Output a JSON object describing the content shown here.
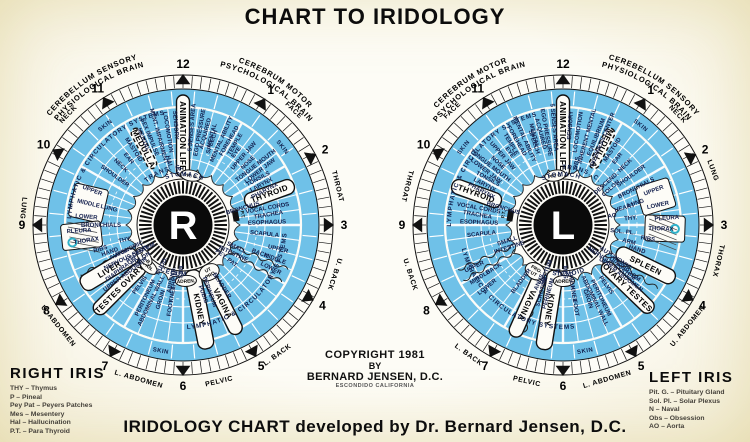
{
  "title": "CHART TO IRIDOLOGY",
  "caption": "IRIDOLOGY CHART developed by Dr. Bernard Jensen, D.C.",
  "copyright": [
    "COPYRIGHT 1981",
    "BY",
    "BERNARD JENSEN, D.C.",
    "ESCONDIDO CALIFORNIA"
  ],
  "colors": {
    "blue": "#6fc1e8",
    "paper": "#fdfcf7",
    "ink": "#0c0c0c",
    "navy": "#14204e",
    "teal": "#2fb1c9"
  },
  "legends": {
    "right": {
      "title": "RIGHT IRIS",
      "items": [
        "THY – Thymus",
        "P – Pineal",
        "Pey Pat – Peyers Patches",
        "Mes – Mesentery",
        "Hal – Hallucination",
        "P.T. – Para Thyroid"
      ]
    },
    "left": {
      "title": "LEFT IRIS",
      "items": [
        "Pit. G. – Pituitary Gland",
        "Sol. Pl. – Solar Plexus",
        "N – Naval",
        "Obs – Obsession",
        "AO – Aorta"
      ]
    }
  },
  "iris_right": {
    "letter": "R",
    "arcs_top": [
      [
        "CEREBELLUM SENSORY",
        -33,
        172
      ],
      [
        "PHYSIOLOGICAL BRAIN",
        -32,
        163
      ],
      [
        "CEREBRUM MOTOR",
        33,
        172
      ],
      [
        "PSYCHOLOGICAL BRAIN",
        32,
        163
      ]
    ],
    "numbers": [
      [
        "12",
        0
      ],
      [
        "1",
        33
      ],
      [
        "2",
        62
      ],
      [
        "3",
        90
      ],
      [
        "4",
        120
      ],
      [
        "5",
        151
      ],
      [
        "6",
        180
      ],
      [
        "7",
        209
      ],
      [
        "8",
        238
      ],
      [
        "9",
        270
      ],
      [
        "10",
        300
      ],
      [
        "11",
        328
      ]
    ],
    "outer": [
      [
        "FACE",
        44
      ],
      [
        "THROAT",
        76
      ],
      [
        "U. BACK",
        108
      ],
      [
        "L. BACK",
        144
      ],
      [
        "PELVIC",
        167
      ],
      [
        "L. ABDOMEN",
        196
      ],
      [
        "U. ABDOMEN",
        231
      ],
      [
        "LUNG",
        276
      ],
      [
        "NECK",
        -46
      ]
    ],
    "ring": [
      [
        "SKIN",
        -38
      ],
      [
        "SKIN",
        52
      ],
      [
        "SKIN",
        190
      ]
    ],
    "radial": [
      [
        "SENSORY",
        -4,
        100
      ],
      [
        "LOCOMOTION",
        -9,
        94
      ],
      [
        "MENT. IMPAIRMENT",
        -15,
        92
      ],
      [
        "SEX IMPULSE|MENTAL",
        -22,
        94
      ],
      [
        "MASTOID",
        -33,
        90
      ],
      [
        "EAR",
        -39,
        86
      ],
      [
        "NECK",
        -46,
        86
      ],
      [
        "SHOULDER",
        -54,
        84
      ],
      [
        "HAL.",
        -12,
        64
      ],
      [
        "5 SENSES AREA",
        5,
        98
      ],
      [
        "EGO PRESSURE",
        10,
        94
      ],
      [
        "ACQUIRED|MENTAL",
        15,
        94
      ],
      [
        "SPEECH",
        19,
        88
      ],
      [
        "MENTAL ABILITY",
        24,
        94
      ],
      [
        "FOREHEAD|TEMPLE",
        30,
        96
      ],
      [
        "EYE",
        36,
        90
      ],
      [
        "UPPER JAW",
        41,
        92
      ],
      [
        "NOSE",
        46,
        90
      ],
      [
        "TONGUE MOUTH|LOWER JAW",
        52,
        94
      ],
      [
        "TONSILS|LARYNX|PHARYNX",
        62,
        88
      ],
      [
        "VOCAL CORDS|TRACHEA",
        80,
        86
      ],
      [
        "ESOPHAGUS",
        88,
        84
      ],
      [
        "SCAPULA",
        96,
        82
      ],
      [
        "BRONCHUS",
        74,
        62
      ],
      [
        "UPPER",
        104,
        98
      ],
      [
        "MIDDLE",
        110,
        98
      ],
      [
        "LOWER",
        116,
        98
      ],
      [
        "BACK",
        110,
        82
      ],
      [
        "SMALL|INTESTINE",
        115,
        58
      ],
      [
        "PEY. PAT.",
        127,
        55
      ],
      [
        "BLADDER",
        147,
        72
      ],
      [
        "PERINEUM|PUBIS",
        160,
        72
      ],
      [
        "THIGH",
        189,
        56
      ],
      [
        "KNEE",
        189,
        70
      ],
      [
        "FOOT",
        189,
        84
      ],
      [
        "GROIN",
        197,
        78
      ],
      [
        "PERITONEUM|ABDOMINAL WALL",
        206,
        82
      ],
      [
        "PELVIS",
        216,
        74
      ],
      [
        "DIAPHRAGM|UPPER ABDOMEN",
        233,
        76
      ],
      [
        "ASCEND.|COLON",
        236,
        54
      ],
      [
        "AUTONOMIC|NERVOUS SYSTEM",
        244,
        62
      ],
      [
        "ARM",
        246,
        68
      ],
      [
        "HAND",
        250,
        78
      ],
      [
        "RIBS",
        254,
        86
      ],
      [
        "THORAX",
        261,
        98
      ],
      [
        "PLEURA",
        267,
        104
      ],
      [
        "LOWER",
        275,
        97
      ],
      [
        "MIDDLE",
        283,
        97
      ],
      [
        "UPPER",
        291,
        97
      ],
      [
        "LUNG",
        283,
        76
      ],
      [
        "BRONCHIALS",
        270,
        82
      ],
      [
        "THY.",
        256,
        60
      ],
      [
        "P.",
        -4,
        56
      ],
      [
        "DUOD.",
        208,
        46
      ],
      [
        "MES.",
        183,
        48
      ],
      [
        "APPEND.",
        192,
        56
      ]
    ],
    "arcs": [
      [
        "LYMPHATIC & CIRCULATORY SYSTEMS",
        -48,
        112,
        0
      ],
      [
        "LYMPHATIC & CIRCULATORY SYSTEMS",
        136,
        104,
        1
      ],
      [
        "TRANS. C.",
        -20,
        56,
        0
      ],
      [
        "STOMACH",
        2,
        49,
        0
      ],
      [
        "CECUM",
        191,
        51,
        1
      ]
    ],
    "banners": [
      [
        "ANIMATION LIFE",
        0,
        48,
        130,
        13,
        0
      ],
      [
        "MEDULLA",
        -27,
        64,
        108,
        10,
        1
      ],
      [
        "THYROID",
        70,
        66,
        118,
        15,
        0
      ],
      [
        "VAGINA",
        153,
        54,
        122,
        14,
        0
      ],
      [
        "KIDNEY",
        169,
        46,
        126,
        16,
        0
      ],
      [
        "TESTES OVARY",
        225,
        56,
        124,
        14,
        0
      ],
      [
        "LIVER",
        239,
        54,
        118,
        17,
        0
      ]
    ],
    "patches": [
      [
        283,
        80,
        114,
        34
      ],
      [
        264,
        82,
        122,
        26
      ]
    ],
    "ovals": [
      [
        "PIT. G.",
        9,
        50
      ],
      [
        "UT|PRO.",
        151,
        54
      ],
      [
        "ADREN.",
        177,
        56
      ],
      [
        "PAN.",
        220,
        54
      ],
      [
        "GALL B.",
        231,
        50
      ]
    ],
    "boxes": [
      [
        "P.T.",
        80,
        54
      ]
    ],
    "squiggles": [
      113,
      120,
      244
    ],
    "hatch": [
      261
    ],
    "dots": [
      [
        261,
        112
      ]
    ]
  },
  "iris_left": {
    "letter": "L",
    "arcs_top": [
      [
        "CEREBRUM MOTOR",
        -33,
        172
      ],
      [
        "PSYCHOLOGICAL BRAIN",
        -32,
        163
      ],
      [
        "CEREBELLUM SENSORY",
        33,
        172
      ],
      [
        "PHYSIOLOGICAL BRAIN",
        32,
        163
      ]
    ],
    "numbers": [
      [
        "12",
        0
      ],
      [
        "1",
        33
      ],
      [
        "2",
        62
      ],
      [
        "3",
        90
      ],
      [
        "4",
        120
      ],
      [
        "5",
        151
      ],
      [
        "6",
        180
      ],
      [
        "7",
        209
      ],
      [
        "8",
        238
      ],
      [
        "9",
        270
      ],
      [
        "10",
        300
      ],
      [
        "11",
        328
      ]
    ],
    "outer": [
      [
        "FACE",
        -44
      ],
      [
        "THROAT",
        -76
      ],
      [
        "U. BACK",
        -108
      ],
      [
        "L. BACK",
        -144
      ],
      [
        "PELVIC",
        -167
      ],
      [
        "L. ABDOMEN",
        -196
      ],
      [
        "U. ABDOMEN",
        -231
      ],
      [
        "LUNG",
        70
      ],
      [
        "THORAX",
        103
      ],
      [
        "NECK",
        46
      ]
    ],
    "ring": [
      [
        "SKIN",
        38
      ],
      [
        "SKIN",
        -52
      ],
      [
        "SKIN",
        170
      ]
    ],
    "radial": [
      [
        "5 SENSES AREA",
        -5,
        98
      ],
      [
        "EGO PRESSURE",
        -10,
        94
      ],
      [
        "ACQUIRED|MENTAL",
        -15,
        94
      ],
      [
        "SPEECH",
        -19,
        88
      ],
      [
        "MENTAL ABILITY",
        -24,
        94
      ],
      [
        "FOREHEAD|TEMPLE",
        -30,
        96
      ],
      [
        "EYE",
        -36,
        90
      ],
      [
        "UPPER JAW",
        -41,
        92
      ],
      [
        "NOSE",
        -46,
        90
      ],
      [
        "TONGUE MOUTH|LOWER JAW",
        -52,
        94
      ],
      [
        "TONSILS|LARYNX|PHARYNX",
        -62,
        88
      ],
      [
        "VOCAL CORDS|TRACHEA",
        -80,
        86
      ],
      [
        "ESOPHAGUS",
        -88,
        84
      ],
      [
        "SCAPULA",
        -96,
        82
      ],
      [
        "BRONCHUS",
        -74,
        62
      ],
      [
        "SENSORY",
        4,
        100
      ],
      [
        "LOCOMOTION",
        9,
        94
      ],
      [
        "INHERENT MENTAL",
        15,
        92
      ],
      [
        "EQUILIBRIUM|DIZZINESS CENTER",
        22,
        94
      ],
      [
        "MASTOID",
        33,
        90
      ],
      [
        "EAR",
        39,
        86
      ],
      [
        "NECK",
        46,
        86
      ],
      [
        "SHOULDER",
        54,
        84
      ],
      [
        "OBS.",
        12,
        64
      ],
      [
        "UPPER",
        69,
        97
      ],
      [
        "LOWER",
        78,
        97
      ],
      [
        "LUNG",
        73,
        76
      ],
      [
        "BRONCHIALS",
        63,
        82
      ],
      [
        "PLEURA",
        86,
        104
      ],
      [
        "THORAX",
        92,
        98
      ],
      [
        "RIBS",
        99,
        86
      ],
      [
        "ARM",
        104,
        68
      ],
      [
        "HAND",
        108,
        78
      ],
      [
        "HEART",
        74,
        64
      ],
      [
        "THY.",
        84,
        68
      ],
      [
        "SOL. PL.",
        96,
        60
      ],
      [
        "AO",
        79,
        50
      ],
      [
        "DESCEND.|COLON",
        48,
        60
      ],
      [
        "DIAPHRAGM|UPPER ABDOMEN",
        127,
        76
      ],
      [
        "PELVIS",
        144,
        74
      ],
      [
        "PERITONEUM|ABDOMINAL WALL",
        154,
        82
      ],
      [
        "GROIN",
        161,
        78
      ],
      [
        "THIGH",
        171,
        56
      ],
      [
        "KNEE",
        171,
        70
      ],
      [
        "FOOT",
        171,
        84
      ],
      [
        "MES.",
        177,
        48
      ],
      [
        "N",
        186,
        46
      ],
      [
        "SCROTUM|PERINEUM",
        196,
        70
      ],
      [
        "ANUS",
        203,
        62
      ],
      [
        "RECTUM",
        200,
        50
      ],
      [
        "BLADDER",
        217,
        70
      ],
      [
        "LOWER",
        231,
        98
      ],
      [
        "MIDDLE",
        238,
        98
      ],
      [
        "UPPER",
        245,
        98
      ],
      [
        "BACK",
        238,
        82
      ],
      [
        "SMALL|INTESTINE",
        252,
        58
      ],
      [
        "AUTONOMIC|NERVOUS SYSTEM",
        124,
        62
      ]
    ],
    "arcs": [
      [
        "LYMPHATIC & CIRCULATORY SYSTEMS",
        -52,
        112,
        0
      ],
      [
        "LYMPHATIC & CIRCULATORY SYSTEMS",
        215,
        104,
        1
      ],
      [
        "TRANS. C.",
        20,
        56,
        0
      ],
      [
        "STOMACH",
        -2,
        49,
        0
      ],
      [
        "SIGMOID",
        173,
        51,
        1
      ]
    ],
    "banners": [
      [
        "ANIMATION LIFE",
        0,
        48,
        130,
        13,
        0
      ],
      [
        "MEDULLA",
        27,
        64,
        108,
        10,
        1
      ],
      [
        "THYROID",
        -70,
        66,
        118,
        15,
        0
      ],
      [
        "SPLEEN",
        116,
        60,
        124,
        15,
        0
      ],
      [
        "OVARY TESTES",
        134,
        56,
        124,
        14,
        0
      ],
      [
        "KIDNEY",
        189,
        46,
        126,
        16,
        0
      ],
      [
        "VAGINA",
        204,
        54,
        122,
        14,
        0
      ]
    ],
    "patches": [
      [
        73,
        80,
        114,
        30
      ],
      [
        92,
        82,
        122,
        26
      ]
    ],
    "ovals": [
      [
        "PIT. G.",
        -9,
        50
      ],
      [
        "PRO.|UT",
        211,
        54
      ],
      [
        "ADREN.",
        179,
        56
      ]
    ],
    "boxes": [
      [
        "P.T.",
        -80,
        54
      ]
    ],
    "squiggles": [
      241,
      247,
      124,
      200
    ],
    "hatch": [
      92
    ],
    "dots": [
      [
        92,
        112
      ]
    ]
  }
}
